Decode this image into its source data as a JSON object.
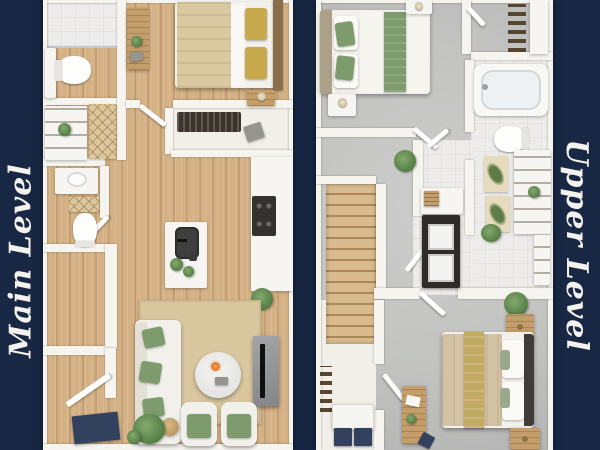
{
  "page": {
    "type": "two-panel-3d-floor-plan-flyer",
    "background_color": "#182743",
    "label_text_color": "#f4f2ec"
  },
  "panels": [
    {
      "id": "main-level",
      "label": "Main Level",
      "flooring": "light-hardwood",
      "rooms": [
        "bathroom",
        "bedroom",
        "closet",
        "pantry",
        "powder-room",
        "kitchen",
        "living-room",
        "entry"
      ]
    },
    {
      "id": "upper-level",
      "label": "Upper Level",
      "flooring": "gray-concrete-and-tile",
      "rooms": [
        "bedroom",
        "walk-in-closet",
        "bathroom",
        "hallway",
        "staircase",
        "laundry-closet",
        "second-bedroom",
        "closet"
      ]
    }
  ],
  "palette": {
    "navy": "#182743",
    "wall": "#f6f4ef",
    "wood": "#d5b286",
    "concrete": "#c2c3c1",
    "tile": "#edecea",
    "sage": "#7d9b6d",
    "gold": "#c9a94e",
    "rug": "#d9c7a0",
    "dark": "#2e2c29",
    "navy_accent": "#32415e",
    "label": "#f4f2ec"
  }
}
